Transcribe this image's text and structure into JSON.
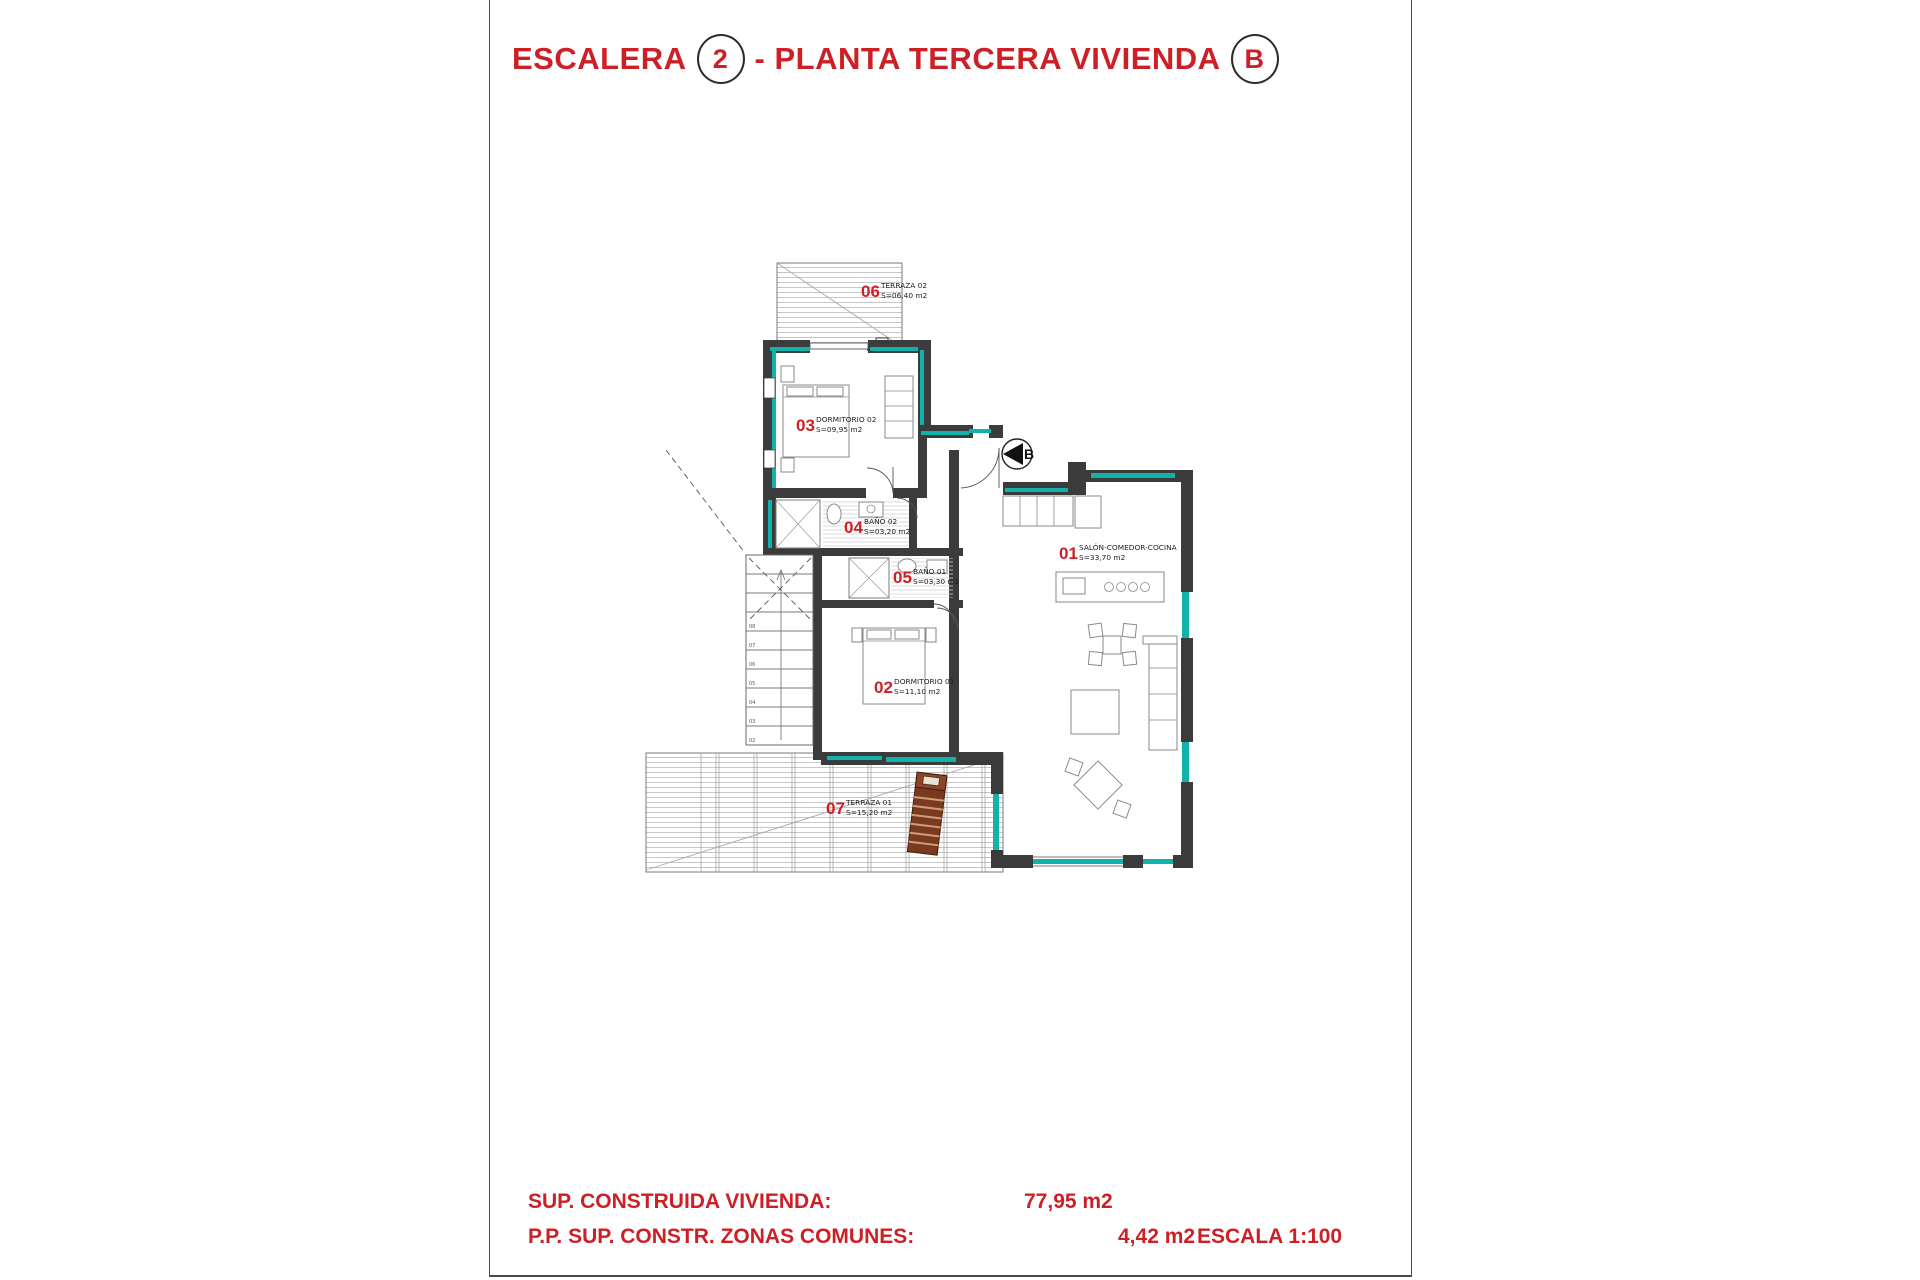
{
  "title": {
    "word1": "ESCALERA",
    "badge1": "2",
    "word2": "- PLANTA TERCERA VIVIENDA",
    "badge2": "B"
  },
  "plan": {
    "compass_letter": "B",
    "rooms": [
      {
        "num": "01",
        "name": "SALÓN-COMEDOR-COCINA",
        "area": "S=33,70 m2"
      },
      {
        "num": "02",
        "name": "DORMITORIO 01",
        "area": "S=11,10 m2"
      },
      {
        "num": "03",
        "name": "DORMITORIO 02",
        "area": "S=09,95 m2"
      },
      {
        "num": "04",
        "name": "BAÑO 02",
        "area": "S=03,20 m2"
      },
      {
        "num": "05",
        "name": "BAÑO 01",
        "area": "S=03,30 m2"
      },
      {
        "num": "06",
        "name": "TERRAZA 02",
        "area": "S=06,40 m2"
      },
      {
        "num": "07",
        "name": "TERRAZA 01",
        "area": "S=15,20 m2"
      }
    ],
    "stair_steps": [
      "02",
      "03",
      "04",
      "05",
      "06",
      "07",
      "08"
    ]
  },
  "footer": {
    "line1_label": "SUP. CONSTRUIDA VIVIENDA:",
    "line1_value": "77,95 m2",
    "line2_label": "P.P. SUP. CONSTR. ZONAS COMUNES:",
    "line2_value": "4,42 m2",
    "scale": "ESCALA 1:100"
  },
  "colors": {
    "accent": "#cd2026",
    "teal": "#12b2aa",
    "wall": "#3b3b3b"
  }
}
